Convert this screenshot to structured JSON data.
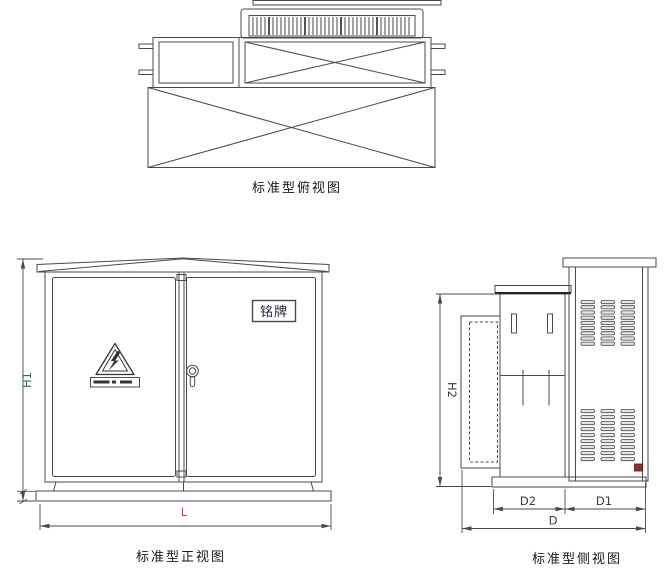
{
  "colors": {
    "line": "#4a4a4a",
    "title_text": "#1a1a1a",
    "h1_label": "#1f6e66",
    "h2_label": "#3a3a3a",
    "l_label": "#c24052",
    "d_label": "#3a3a3a",
    "nameplate_text": "#22223a",
    "drain": "#9e2b25",
    "louver_fill": "#e3e3e3"
  },
  "views": {
    "top": {
      "title": "标准型俯视图"
    },
    "front": {
      "title": "标准型正视图",
      "nameplate_label": "铭牌",
      "dimensions": {
        "height": "H1",
        "length": "L"
      }
    },
    "side": {
      "title": "标准型侧视图",
      "dimensions": {
        "height": "H2",
        "rear_depth": "D2",
        "front_depth": "D1",
        "total_depth": "D"
      }
    }
  }
}
